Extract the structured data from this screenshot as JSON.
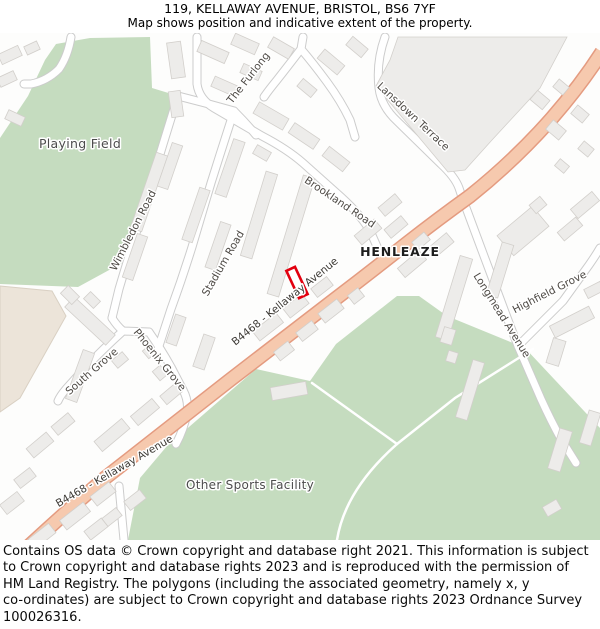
{
  "title": {
    "line1": "119, KELLAWAY AVENUE, BRISTOL, BS6 7YF",
    "line2": "Map shows position and indicative extent of the property."
  },
  "footer": {
    "lines": [
      "Contains OS data © Crown copyright and database right 2021. This information is subject",
      "to Crown copyright and database rights 2023 and is reproduced with the permission of",
      "HM Land Registry. The polygons (including the associated geometry, namely x, y",
      "co-ordinates) are subject to Crown copyright and database rights 2023 Ordnance Survey",
      "100026316."
    ]
  },
  "map": {
    "colors": {
      "background": "#fdfdfc",
      "green_area": "#c5dcbf",
      "green_edge": "#b5cfae",
      "beige_area": "#ece4d9",
      "beige_edge": "#d9d0c3",
      "building_fill": "#edecea",
      "building_edge": "#d2cfcb",
      "road_casing": "#cccccc",
      "road_fill": "#ffffff",
      "main_road_casing": "#e49b80",
      "main_road_fill": "#f6c9ae",
      "marker_red": "#e2000f",
      "label_dark": "#3d3a35",
      "label_gray": "#4e4a45",
      "label_black": "#1d1d1d"
    },
    "areas": [
      {
        "name": "playing-field",
        "fill": "green_area",
        "points": "0,138 28,96 45,60 56,44 90,38 150,37 152,88 175,95 167,140 146,208 122,263 78,287 0,284"
      },
      {
        "name": "other-sports-facility",
        "fill": "green_area",
        "points": "167,446 256,369 310,381 336,344 397,296 419,296 447,316 525,348 600,428 600,540 128,540 140,478"
      },
      {
        "name": "beige-parcel",
        "fill": "beige_area",
        "stroke": "beige_edge",
        "points": "0,286 52,291 66,316 20,398 0,412"
      }
    ],
    "terrace_block": {
      "name": "lansdown-terrace-block",
      "points": "398,37 567,37 540,88 492,140 465,170 448,172 376,86 390,60"
    },
    "minor_roads": [
      {
        "name": "brookland-road",
        "d": "M 197,37 L 197,84 Q 199,99 214,108 L 262,136 Q 287,149 303,163 L 341,197 Q 363,217 371,233 L 379,251"
      },
      {
        "name": "lansdown-terrace-road",
        "d": "M 385,37 Q 376,62 379,88 Q 381,106 397,121 L 441,164 Q 455,177 459,188 L 462,197"
      },
      {
        "name": "the-furlong-road",
        "d": "M 301,49 Q 288,66 277,80 Q 268,91 264,97"
      },
      {
        "name": "furlong-stem-road",
        "d": "M 303,37 Q 302,43 301,49 Q 313,63 327,82 Q 341,101 350,120 L 355,137"
      },
      {
        "name": "wimbledon-road",
        "d": "M 178,96 Q 167,131 157,164 L 137,230 Q 127,262 119,289 L 112,318"
      },
      {
        "name": "stadium-road",
        "d": "M 234,111 Q 222,148 211,183 L 192,247 Q 182,279 171,309 L 157,352"
      },
      {
        "name": "top-connector-road",
        "d": "M 178,96 Q 206,103 234,111 Q 246,123 256,135"
      },
      {
        "name": "junction-connector-road",
        "d": "M 112,318 Q 117,326 123,331 L 149,332"
      },
      {
        "name": "south-grove-road",
        "d": "M 123,331 Q 103,349 84,369 L 66,389 Q 60,396 58,401"
      },
      {
        "name": "phoenix-grove-road",
        "d": "M 149,332 Q 161,349 171,367 L 183,390 Q 189,401 187,413 Q 184,429 176,444"
      },
      {
        "name": "longmead-avenue-road",
        "d": "M 462,197 Q 471,221 481,248 L 499,296 Q 509,323 518,346 L 541,399 Q 551,421 561,439 L 576,463"
      },
      {
        "name": "highfield-grove-road",
        "d": "M 518,346 Q 541,323 563,301 L 589,265 Q 596,255 600,248"
      },
      {
        "name": "bottom-stub-road",
        "d": "M 119,486 L 124,540"
      },
      {
        "name": "left-hook-road",
        "d": "M 71,37 Q 68,56 59,69 Q 47,81 31,84 L 24,84"
      }
    ],
    "footpaths": [
      {
        "name": "sports-path-1",
        "d": "M 312,383 L 397,444"
      },
      {
        "name": "sports-path-2",
        "d": "M 337,540 Q 345,490 397,444"
      },
      {
        "name": "sports-path-3",
        "d": "M 397,444 L 455,398 L 533,349"
      }
    ],
    "main_road": {
      "name": "b4468-kellaway-avenue",
      "d": "M 16,558 Q 60,517 105,478 Q 170,427 230,380 Q 283,339 330,303 Q 368,274 406,244 Q 438,219 470,196 Q 515,160 552,118 Q 580,86 602,52"
    },
    "buildings": [
      [
        10,
        55,
        22,
        11,
        -25
      ],
      [
        7,
        79,
        18,
        10,
        -25
      ],
      [
        15,
        118,
        18,
        10,
        25
      ],
      [
        32,
        48,
        14,
        9,
        -25
      ],
      [
        176,
        60,
        14,
        36,
        -8
      ],
      [
        176,
        104,
        12,
        26,
        -8
      ],
      [
        213,
        52,
        30,
        12,
        24
      ],
      [
        245,
        44,
        26,
        12,
        24
      ],
      [
        224,
        86,
        24,
        11,
        24
      ],
      [
        251,
        72,
        20,
        10,
        24
      ],
      [
        281,
        48,
        24,
        12,
        30
      ],
      [
        307,
        88,
        18,
        10,
        40
      ],
      [
        331,
        62,
        26,
        12,
        40
      ],
      [
        357,
        47,
        20,
        11,
        40
      ],
      [
        271,
        116,
        34,
        13,
        30
      ],
      [
        304,
        136,
        30,
        12,
        34
      ],
      [
        336,
        159,
        26,
        12,
        38
      ],
      [
        262,
        153,
        16,
        10,
        30
      ],
      [
        540,
        100,
        16,
        12,
        40
      ],
      [
        561,
        87,
        13,
        10,
        40
      ],
      [
        556,
        130,
        17,
        12,
        40
      ],
      [
        580,
        114,
        15,
        11,
        40
      ],
      [
        586,
        149,
        13,
        10,
        40
      ],
      [
        562,
        166,
        12,
        9,
        40
      ],
      [
        149,
        192,
        12,
        80,
        19
      ],
      [
        170,
        166,
        11,
        46,
        19
      ],
      [
        135,
        257,
        11,
        46,
        19
      ],
      [
        196,
        215,
        11,
        55,
        19
      ],
      [
        230,
        168,
        12,
        58,
        19
      ],
      [
        218,
        246,
        11,
        48,
        19
      ],
      [
        259,
        215,
        12,
        88,
        17
      ],
      [
        291,
        236,
        12,
        124,
        17
      ],
      [
        268,
        327,
        30,
        12,
        -38
      ],
      [
        296,
        306,
        24,
        12,
        -38
      ],
      [
        322,
        287,
        20,
        11,
        -38
      ],
      [
        204,
        352,
        12,
        34,
        19
      ],
      [
        176,
        330,
        11,
        30,
        19
      ],
      [
        331,
        311,
        24,
        12,
        -38
      ],
      [
        307,
        331,
        20,
        11,
        -38
      ],
      [
        284,
        351,
        18,
        11,
        -38
      ],
      [
        356,
        296,
        13,
        11,
        -38
      ],
      [
        368,
        232,
        26,
        12,
        -40
      ],
      [
        396,
        227,
        22,
        11,
        -40
      ],
      [
        421,
        241,
        16,
        10,
        -40
      ],
      [
        390,
        205,
        22,
        11,
        -40
      ],
      [
        412,
        264,
        28,
        12,
        -40
      ],
      [
        441,
        245,
        24,
        12,
        -40
      ],
      [
        523,
        231,
        46,
        26,
        -40
      ],
      [
        454,
        298,
        13,
        85,
        17
      ],
      [
        500,
        270,
        12,
        55,
        17
      ],
      [
        538,
        205,
        14,
        11,
        -40
      ],
      [
        585,
        205,
        28,
        12,
        -40
      ],
      [
        570,
        229,
        24,
        11,
        -40
      ],
      [
        572,
        322,
        44,
        13,
        -27
      ],
      [
        556,
        352,
        13,
        26,
        17
      ],
      [
        594,
        290,
        18,
        10,
        -27
      ],
      [
        470,
        390,
        12,
        60,
        17
      ],
      [
        560,
        450,
        13,
        42,
        17
      ],
      [
        590,
        428,
        12,
        34,
        17
      ],
      [
        552,
        508,
        16,
        11,
        -30
      ],
      [
        448,
        336,
        12,
        16,
        17
      ],
      [
        452,
        357,
        10,
        11,
        17
      ],
      [
        289,
        391,
        36,
        13,
        -10
      ],
      [
        112,
        435,
        36,
        13,
        -40
      ],
      [
        145,
        412,
        28,
        12,
        -40
      ],
      [
        171,
        394,
        20,
        11,
        -40
      ],
      [
        80,
        376,
        12,
        52,
        20
      ],
      [
        90,
        321,
        56,
        14,
        43
      ],
      [
        40,
        445,
        26,
        12,
        -40
      ],
      [
        63,
        424,
        22,
        11,
        -40
      ],
      [
        25,
        478,
        20,
        11,
        -38
      ],
      [
        12,
        503,
        22,
        12,
        -38
      ],
      [
        75,
        516,
        30,
        12,
        -38
      ],
      [
        103,
        494,
        24,
        12,
        -38
      ],
      [
        96,
        529,
        22,
        11,
        -38
      ],
      [
        135,
        500,
        20,
        11,
        -38
      ],
      [
        112,
        517,
        18,
        10,
        -38
      ],
      [
        42,
        536,
        26,
        12,
        -38
      ],
      [
        70,
        295,
        16,
        11,
        45
      ],
      [
        92,
        300,
        14,
        10,
        45
      ],
      [
        120,
        360,
        14,
        10,
        -40
      ],
      [
        160,
        373,
        12,
        10,
        50
      ],
      [
        149,
        352,
        10,
        9,
        50
      ]
    ],
    "marker": {
      "name": "property-marker",
      "cx": 297,
      "cy": 282.5,
      "w": 9.5,
      "h": 30,
      "rot": -25
    },
    "labels": [
      {
        "name": "label-playing-field",
        "text": "Playing Field",
        "x": 80,
        "y": 148,
        "rot": 0,
        "size": 12.5,
        "color": "#4c4c4c",
        "ls": 0.3,
        "weight": "normal"
      },
      {
        "name": "label-other-sports-facility",
        "text": "Other Sports Facility",
        "x": 250,
        "y": 489,
        "rot": 0,
        "size": 12,
        "color": "#4c4c4c",
        "ls": 0.3,
        "weight": "normal"
      },
      {
        "name": "label-henleaze",
        "text": "HENLEAZE",
        "x": 400,
        "y": 256,
        "rot": 0,
        "size": 12.5,
        "color": "#1d1d1d",
        "ls": 0.8,
        "weight": "600"
      },
      {
        "name": "label-the-furlong",
        "text": "The Furlong",
        "x": 251,
        "y": 80,
        "rot": -52,
        "size": 10.5,
        "color": "#4e4a45",
        "ls": 0,
        "weight": "normal"
      },
      {
        "name": "label-lansdown-terrace",
        "text": "Lansdown Terrace",
        "x": 411,
        "y": 119,
        "rot": 43,
        "size": 10.5,
        "color": "#4e4a45",
        "ls": 0,
        "weight": "normal"
      },
      {
        "name": "label-brookland-road",
        "text": "Brookland Road",
        "x": 338,
        "y": 205,
        "rot": 34,
        "size": 10.5,
        "color": "#4e4a45",
        "ls": 0,
        "weight": "normal"
      },
      {
        "name": "label-wimbledon-road",
        "text": "Wimbledon Road",
        "x": 136,
        "y": 232,
        "rot": -63,
        "size": 10.5,
        "color": "#4e4a45",
        "ls": 0,
        "weight": "normal"
      },
      {
        "name": "label-stadium-road",
        "text": "Stadium Road",
        "x": 226,
        "y": 265,
        "rot": -60,
        "size": 10.5,
        "color": "#4e4a45",
        "ls": 0,
        "weight": "normal"
      },
      {
        "name": "label-south-grove",
        "text": "South Grove",
        "x": 94,
        "y": 374,
        "rot": -41,
        "size": 10.5,
        "color": "#4e4a45",
        "ls": 0,
        "weight": "normal"
      },
      {
        "name": "label-phoenix-grove",
        "text": "Phoenix Grove",
        "x": 157,
        "y": 362,
        "rot": 51,
        "size": 10.5,
        "color": "#4e4a45",
        "ls": 0,
        "weight": "normal"
      },
      {
        "name": "label-longmead-avenue",
        "text": "Longmead Avenue",
        "x": 499,
        "y": 317,
        "rot": 58,
        "size": 10.5,
        "color": "#4e4a45",
        "ls": 0,
        "weight": "normal"
      },
      {
        "name": "label-highfield-grove",
        "text": "Highfield Grove",
        "x": 551,
        "y": 295,
        "rot": -27,
        "size": 10.5,
        "color": "#4e4a45",
        "ls": 0,
        "weight": "normal"
      },
      {
        "name": "label-b4468-mid",
        "text": "B4468 - Kellaway Avenue",
        "x": 287,
        "y": 304,
        "rot": -39,
        "size": 10.5,
        "color": "#3d3a35",
        "ls": 0,
        "weight": "normal"
      },
      {
        "name": "label-b4468-bottom",
        "text": "B4468 - Kellaway Avenue",
        "x": 116,
        "y": 474,
        "rot": -30,
        "size": 10.5,
        "color": "#3d3a35",
        "ls": 0,
        "weight": "normal"
      }
    ]
  }
}
